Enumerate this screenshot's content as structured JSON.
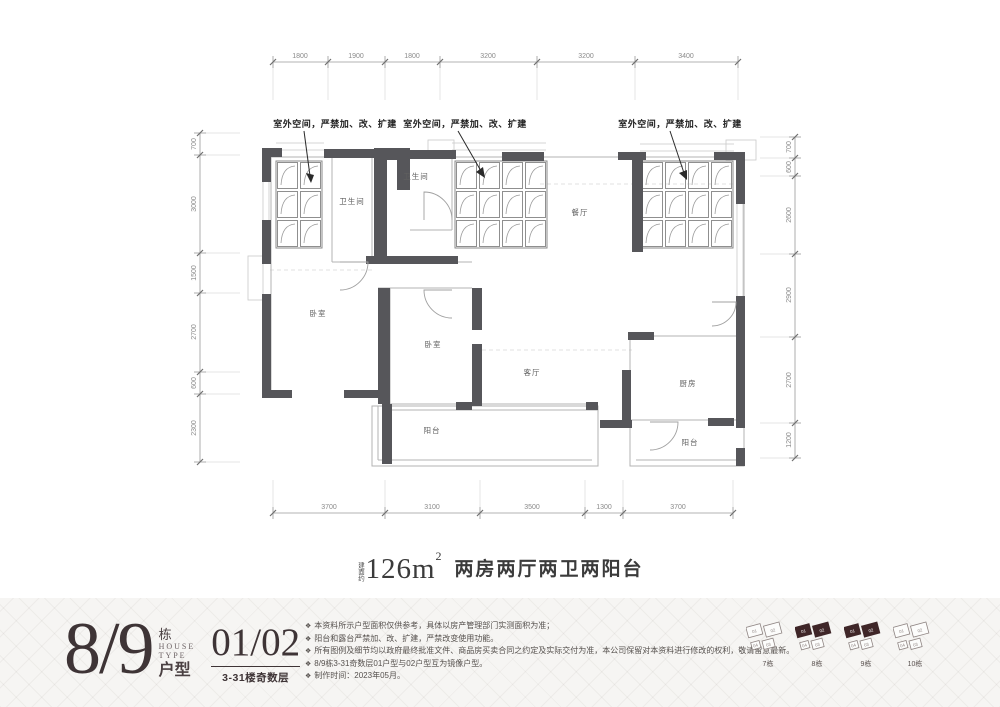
{
  "plan": {
    "callout_label": "室外空间，严禁加、改、扩建",
    "rooms": [
      "卫生间",
      "卫生间",
      "餐厅",
      "卧室",
      "卧室",
      "客厅",
      "阳台",
      "厨房",
      "阳台"
    ],
    "dims_top": [
      "1800",
      "1900",
      "1800",
      "3200",
      "3200",
      "3400"
    ],
    "dims_bottom": [
      "3700",
      "3100",
      "3500",
      "1300",
      "3700"
    ],
    "dims_left": [
      "700",
      "3000",
      "1500",
      "2700",
      "600",
      "2300"
    ],
    "dims_right": [
      "700",
      "600",
      "2600",
      "2900",
      "2700",
      "1200"
    ]
  },
  "title": {
    "prefix": "建面约",
    "area": "126m",
    "sup": "2",
    "desc": "两房两厅两卫两阳台"
  },
  "footer": {
    "bullet": "❖",
    "block_number": "8/9",
    "block_label": "栋",
    "house": "HOUSE",
    "type": "TYPE",
    "huxing": "户型",
    "unit_numbers": "01/02",
    "floors_label": "3-31楼奇数层",
    "notes": [
      "本资料所示户型面积仅供参考，具体以房产管理部门实测面积为准；",
      "阳台和露台严禁加、改、扩建，严禁改变使用功能。",
      "所有图例及细节均以政府最终批准文件、商品房买卖合同之约定及实际交付为准，本公司保留对本资料进行修改的权利，敬请留意最新。",
      "8/9栋3-31奇数层01户型与02户型互为镜像户型。",
      "制作时间：2023年05月。"
    ],
    "thumb_units": [
      "01",
      "02",
      "03",
      "04"
    ],
    "thumbnails": [
      {
        "label": "7栋",
        "highlighted": false
      },
      {
        "label": "8栋",
        "highlighted": true
      },
      {
        "label": "9栋",
        "highlighted": true
      },
      {
        "label": "10栋",
        "highlighted": false
      }
    ]
  },
  "colors": {
    "wall": "#56565a",
    "accent_dark": "#3e3436",
    "thumb_highlight": "#3f2628"
  }
}
